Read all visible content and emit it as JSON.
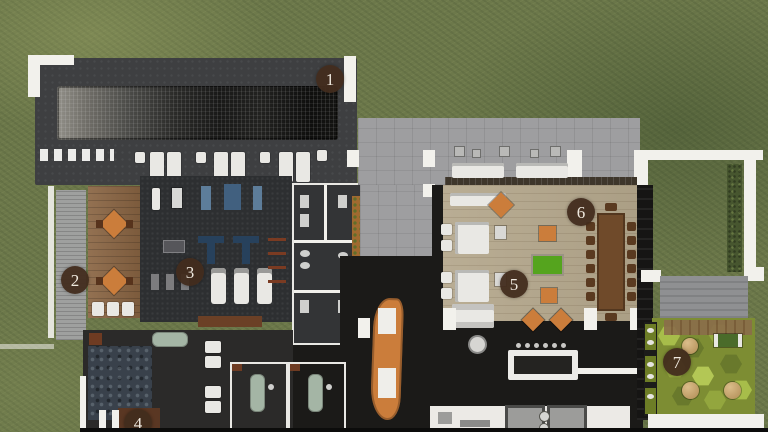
{
  "scene": {
    "type": "architectural floor plan render, top-down, on lawn",
    "markers": [
      {
        "label": "1"
      },
      {
        "label": "2"
      },
      {
        "label": "3"
      },
      {
        "label": "4"
      },
      {
        "label": "5"
      },
      {
        "label": "6"
      },
      {
        "label": "7"
      }
    ]
  },
  "colors": {
    "grass": "#6c784a",
    "slab": "#3e3f41",
    "wall": "#f2f1ec",
    "wood_terrace": "#8a6543",
    "wood_floor": "#b4a78c",
    "deck": "#9e9ea0",
    "dark_floor": "#1b1a18",
    "gym_floor": "#2d2f31",
    "orange": "#cb7d3b",
    "billiard": "#55a41e",
    "sage": "#a4b5a5",
    "navy": "#27415c",
    "hedge": "#47562f",
    "hex_olive": "#7d8d33",
    "pad": "#8f9092",
    "marker": "rgba(66,44,29,0.95)",
    "marker_text": "#efe9df",
    "table_brown": "#6f4a2a"
  }
}
